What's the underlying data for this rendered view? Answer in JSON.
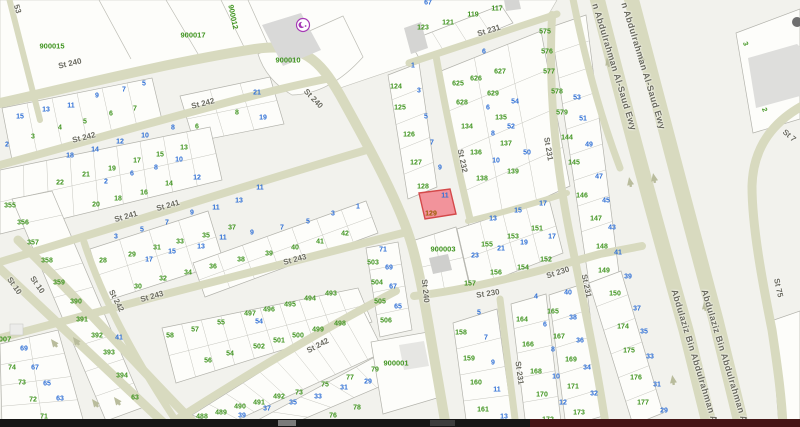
{
  "map": {
    "title": "parcel-map",
    "colors": {
      "background": "#f2f2ed",
      "block_fill": "#fdfdfa",
      "road_fill": "#d8dabf",
      "arrow": "#b9bc9c",
      "parcel_green": "#3f941f",
      "parcel_blue": "#2e6fd6",
      "street_label": "#6b6b60",
      "highlight_fill": "#f2939b",
      "highlight_stroke": "#d4494a",
      "highlight_number": "#9a5d00",
      "building": "#d9d9d8",
      "mosque": "#a63ab5"
    },
    "highlight": {
      "plot": "129",
      "unit": "11"
    },
    "landmark_labels": [
      [
        "900015",
        52,
        46,
        0
      ],
      [
        "900017",
        193,
        35,
        0
      ],
      [
        "900012",
        233,
        17,
        78
      ],
      [
        "900010",
        288,
        60,
        0
      ],
      [
        "900003",
        443,
        249,
        0
      ],
      [
        "900001",
        396,
        363,
        0
      ],
      [
        "007",
        5,
        339,
        0
      ]
    ],
    "street_labels": [
      [
        "St 240",
        70,
        64,
        -13
      ],
      [
        "St 240",
        313,
        99,
        46
      ],
      [
        "St 240",
        425,
        291,
        84
      ],
      [
        "St 242",
        203,
        104,
        -14
      ],
      [
        "St 242",
        84,
        138,
        -14
      ],
      [
        "St 242",
        116,
        301,
        62
      ],
      [
        "St 242",
        318,
        346,
        -28
      ],
      [
        "St 241",
        126,
        217,
        -16
      ],
      [
        "St 241",
        168,
        206,
        -16
      ],
      [
        "St 243",
        152,
        297,
        -16
      ],
      [
        "St 243",
        295,
        260,
        -15
      ],
      [
        "St 10",
        14,
        286,
        55
      ],
      [
        "St 10",
        37,
        285,
        55
      ],
      [
        "St 230",
        488,
        294,
        -9
      ],
      [
        "St 230",
        558,
        273,
        -18
      ],
      [
        "St 231",
        489,
        31,
        -17
      ],
      [
        "St 231",
        548,
        149,
        80
      ],
      [
        "St 231",
        586,
        286,
        78
      ],
      [
        "St 231",
        519,
        373,
        82
      ],
      [
        "St 232",
        462,
        161,
        78
      ],
      [
        "St 7",
        789,
        136,
        40
      ],
      [
        "St 75",
        778,
        288,
        78
      ],
      [
        "53",
        17,
        9,
        73
      ]
    ],
    "highway_labels": [
      [
        "n Abdulrahman Al-Saud Ewy",
        614,
        67,
        73
      ],
      [
        "n Abdulrahman Al-Saud Ewy",
        643,
        66,
        73
      ],
      [
        "Abdulaziz Bin Abdulrahman A",
        694,
        356,
        73
      ],
      [
        "Abdulaziz Bin Abdulrahman A",
        724,
        356,
        73
      ]
    ],
    "parcel_numbers_green": [
      [
        "3",
        33,
        137
      ],
      [
        "4",
        60,
        128
      ],
      [
        "5",
        85,
        122
      ],
      [
        "6",
        111,
        114
      ],
      [
        "7",
        135,
        109
      ],
      [
        "6",
        197,
        127
      ],
      [
        "8",
        237,
        113
      ],
      [
        "22",
        60,
        183
      ],
      [
        "21",
        86,
        175
      ],
      [
        "19",
        112,
        169
      ],
      [
        "17",
        137,
        161
      ],
      [
        "15",
        160,
        155
      ],
      [
        "13",
        184,
        148
      ],
      [
        "20",
        96,
        205
      ],
      [
        "18",
        118,
        199
      ],
      [
        "16",
        144,
        193
      ],
      [
        "14",
        169,
        184
      ],
      [
        "355",
        10,
        206
      ],
      [
        "356",
        23,
        223
      ],
      [
        "357",
        33,
        243
      ],
      [
        "358",
        47,
        261
      ],
      [
        "359",
        59,
        283
      ],
      [
        "390",
        76,
        302
      ],
      [
        "391",
        82,
        320
      ],
      [
        "392",
        97,
        336
      ],
      [
        "393",
        109,
        353
      ],
      [
        "394",
        122,
        376
      ],
      [
        "63",
        135,
        398
      ],
      [
        "74",
        12,
        368
      ],
      [
        "73",
        22,
        383
      ],
      [
        "72",
        33,
        400
      ],
      [
        "71",
        44,
        417
      ],
      [
        "28",
        103,
        261
      ],
      [
        "29",
        132,
        255
      ],
      [
        "30",
        138,
        287
      ],
      [
        "31",
        157,
        248
      ],
      [
        "32",
        163,
        279
      ],
      [
        "33",
        180,
        242
      ],
      [
        "34",
        188,
        273
      ],
      [
        "35",
        206,
        236
      ],
      [
        "36",
        213,
        267
      ],
      [
        "37",
        232,
        228
      ],
      [
        "38",
        241,
        260
      ],
      [
        "39",
        269,
        254
      ],
      [
        "40",
        295,
        248
      ],
      [
        "41",
        320,
        242
      ],
      [
        "42",
        345,
        234
      ],
      [
        "58",
        170,
        336
      ],
      [
        "57",
        195,
        330
      ],
      [
        "55",
        221,
        323
      ],
      [
        "54",
        230,
        354
      ],
      [
        "56",
        208,
        361
      ],
      [
        "497",
        250,
        314
      ],
      [
        "496",
        269,
        310
      ],
      [
        "495",
        290,
        305
      ],
      [
        "494",
        310,
        299
      ],
      [
        "493",
        331,
        294
      ],
      [
        "502",
        259,
        347
      ],
      [
        "501",
        279,
        341
      ],
      [
        "500",
        298,
        336
      ],
      [
        "499",
        318,
        330
      ],
      [
        "498",
        340,
        324
      ],
      [
        "488",
        202,
        417
      ],
      [
        "489",
        221,
        413
      ],
      [
        "490",
        240,
        407
      ],
      [
        "491",
        259,
        403
      ],
      [
        "492",
        279,
        397
      ],
      [
        "73",
        299,
        393
      ],
      [
        "75",
        325,
        385
      ],
      [
        "77",
        350,
        378
      ],
      [
        "79",
        375,
        370
      ],
      [
        "76",
        333,
        416
      ],
      [
        "78",
        357,
        408
      ],
      [
        "74",
        304,
        425
      ],
      [
        "503",
        373,
        263
      ],
      [
        "504",
        377,
        283
      ],
      [
        "505",
        380,
        302
      ],
      [
        "506",
        386,
        321
      ],
      [
        "484",
        408,
        423
      ],
      [
        "123",
        423,
        28
      ],
      [
        "121",
        448,
        23
      ],
      [
        "119",
        473,
        15
      ],
      [
        "117",
        497,
        9
      ],
      [
        "124",
        396,
        87
      ],
      [
        "125",
        400,
        108
      ],
      [
        "126",
        409,
        135
      ],
      [
        "127",
        416,
        163
      ],
      [
        "128",
        423,
        187
      ],
      [
        "625",
        458,
        84
      ],
      [
        "626",
        476,
        79
      ],
      [
        "627",
        500,
        72
      ],
      [
        "628",
        462,
        103
      ],
      [
        "629",
        493,
        94
      ],
      [
        "135",
        501,
        118
      ],
      [
        "134",
        467,
        127
      ],
      [
        "136",
        476,
        153
      ],
      [
        "137",
        506,
        144
      ],
      [
        "138",
        482,
        179
      ],
      [
        "139",
        513,
        172
      ],
      [
        "575",
        545,
        32
      ],
      [
        "576",
        547,
        52
      ],
      [
        "577",
        549,
        72
      ],
      [
        "578",
        557,
        92
      ],
      [
        "579",
        562,
        113
      ],
      [
        "144",
        567,
        138
      ],
      [
        "145",
        574,
        163
      ],
      [
        "146",
        582,
        196
      ],
      [
        "147",
        596,
        219
      ],
      [
        "148",
        602,
        247
      ],
      [
        "149",
        604,
        271
      ],
      [
        "150",
        615,
        294
      ],
      [
        "174",
        623,
        327
      ],
      [
        "175",
        629,
        351
      ],
      [
        "176",
        636,
        378
      ],
      [
        "177",
        643,
        403
      ],
      [
        "155",
        487,
        245
      ],
      [
        "153",
        513,
        237
      ],
      [
        "151",
        537,
        229
      ],
      [
        "157",
        470,
        284
      ],
      [
        "156",
        496,
        273
      ],
      [
        "154",
        523,
        268
      ],
      [
        "152",
        546,
        260
      ],
      [
        "158",
        461,
        333
      ],
      [
        "164",
        522,
        320
      ],
      [
        "159",
        469,
        359
      ],
      [
        "160",
        476,
        383
      ],
      [
        "161",
        483,
        410
      ],
      [
        "166",
        528,
        345
      ],
      [
        "168",
        536,
        372
      ],
      [
        "170",
        542,
        395
      ],
      [
        "172",
        548,
        420
      ],
      [
        "165",
        553,
        312
      ],
      [
        "167",
        559,
        337
      ],
      [
        "169",
        571,
        360
      ],
      [
        "171",
        573,
        387
      ],
      [
        "173",
        579,
        413
      ],
      [
        "3",
        745,
        44,
        70
      ],
      [
        "2",
        764,
        110,
        70
      ]
    ],
    "parcel_numbers_blue": [
      [
        "15",
        20,
        117
      ],
      [
        "13",
        46,
        110
      ],
      [
        "11",
        71,
        106
      ],
      [
        "9",
        97,
        96
      ],
      [
        "7",
        124,
        90
      ],
      [
        "5",
        144,
        84
      ],
      [
        "2",
        7,
        145
      ],
      [
        "21",
        257,
        93
      ],
      [
        "19",
        263,
        118
      ],
      [
        "18",
        70,
        156
      ],
      [
        "14",
        95,
        150
      ],
      [
        "12",
        120,
        142
      ],
      [
        "10",
        145,
        136
      ],
      [
        "8",
        173,
        128
      ],
      [
        "2",
        106,
        182
      ],
      [
        "6",
        132,
        174
      ],
      [
        "8",
        156,
        168
      ],
      [
        "10",
        179,
        160
      ],
      [
        "12",
        197,
        178
      ],
      [
        "3",
        116,
        237
      ],
      [
        "5",
        142,
        230
      ],
      [
        "7",
        167,
        223
      ],
      [
        "9",
        192,
        213
      ],
      [
        "11",
        216,
        208
      ],
      [
        "13",
        239,
        201
      ],
      [
        "17",
        149,
        260
      ],
      [
        "15",
        172,
        252
      ],
      [
        "13",
        201,
        247
      ],
      [
        "11",
        223,
        238
      ],
      [
        "9",
        252,
        233
      ],
      [
        "7",
        282,
        228
      ],
      [
        "5",
        308,
        222
      ],
      [
        "3",
        333,
        214
      ],
      [
        "1",
        358,
        207
      ],
      [
        "11",
        260,
        188
      ],
      [
        "41",
        119,
        338
      ],
      [
        "69",
        24,
        349
      ],
      [
        "67",
        35,
        368
      ],
      [
        "65",
        47,
        384
      ],
      [
        "63",
        60,
        399
      ],
      [
        "54",
        259,
        322
      ],
      [
        "39",
        242,
        416
      ],
      [
        "37",
        267,
        409
      ],
      [
        "35",
        293,
        403
      ],
      [
        "33",
        318,
        397
      ],
      [
        "31",
        344,
        388
      ],
      [
        "29",
        368,
        382
      ],
      [
        "71",
        383,
        250
      ],
      [
        "69",
        389,
        268
      ],
      [
        "67",
        393,
        287
      ],
      [
        "65",
        398,
        307
      ],
      [
        "67",
        428,
        3
      ],
      [
        "1",
        413,
        66
      ],
      [
        "3",
        419,
        91
      ],
      [
        "5",
        426,
        117
      ],
      [
        "7",
        432,
        143
      ],
      [
        "9",
        440,
        168
      ],
      [
        "6",
        484,
        52
      ],
      [
        "54",
        515,
        102
      ],
      [
        "6",
        488,
        108
      ],
      [
        "52",
        511,
        127
      ],
      [
        "8",
        493,
        134
      ],
      [
        "10",
        496,
        161
      ],
      [
        "50",
        527,
        153
      ],
      [
        "23",
        475,
        256
      ],
      [
        "21",
        501,
        249
      ],
      [
        "19",
        524,
        243
      ],
      [
        "13",
        493,
        219
      ],
      [
        "15",
        518,
        211
      ],
      [
        "17",
        543,
        204
      ],
      [
        "17",
        552,
        237
      ],
      [
        "5",
        479,
        313
      ],
      [
        "7",
        486,
        338
      ],
      [
        "4",
        536,
        297
      ],
      [
        "9",
        493,
        363
      ],
      [
        "11",
        497,
        390
      ],
      [
        "13",
        504,
        417
      ],
      [
        "53",
        577,
        98
      ],
      [
        "51",
        583,
        119
      ],
      [
        "49",
        589,
        145
      ],
      [
        "47",
        599,
        177
      ],
      [
        "45",
        606,
        201
      ],
      [
        "43",
        612,
        228
      ],
      [
        "41",
        618,
        253
      ],
      [
        "39",
        628,
        277
      ],
      [
        "37",
        637,
        309
      ],
      [
        "35",
        644,
        332
      ],
      [
        "33",
        650,
        357
      ],
      [
        "31",
        657,
        385
      ],
      [
        "29",
        664,
        411
      ],
      [
        "40",
        568,
        293
      ],
      [
        "38",
        573,
        318
      ],
      [
        "36",
        580,
        341
      ],
      [
        "34",
        587,
        368
      ],
      [
        "32",
        594,
        394
      ],
      [
        "6",
        545,
        325
      ],
      [
        "8",
        553,
        350
      ],
      [
        "10",
        556,
        377
      ],
      [
        "12",
        563,
        403
      ]
    ]
  }
}
